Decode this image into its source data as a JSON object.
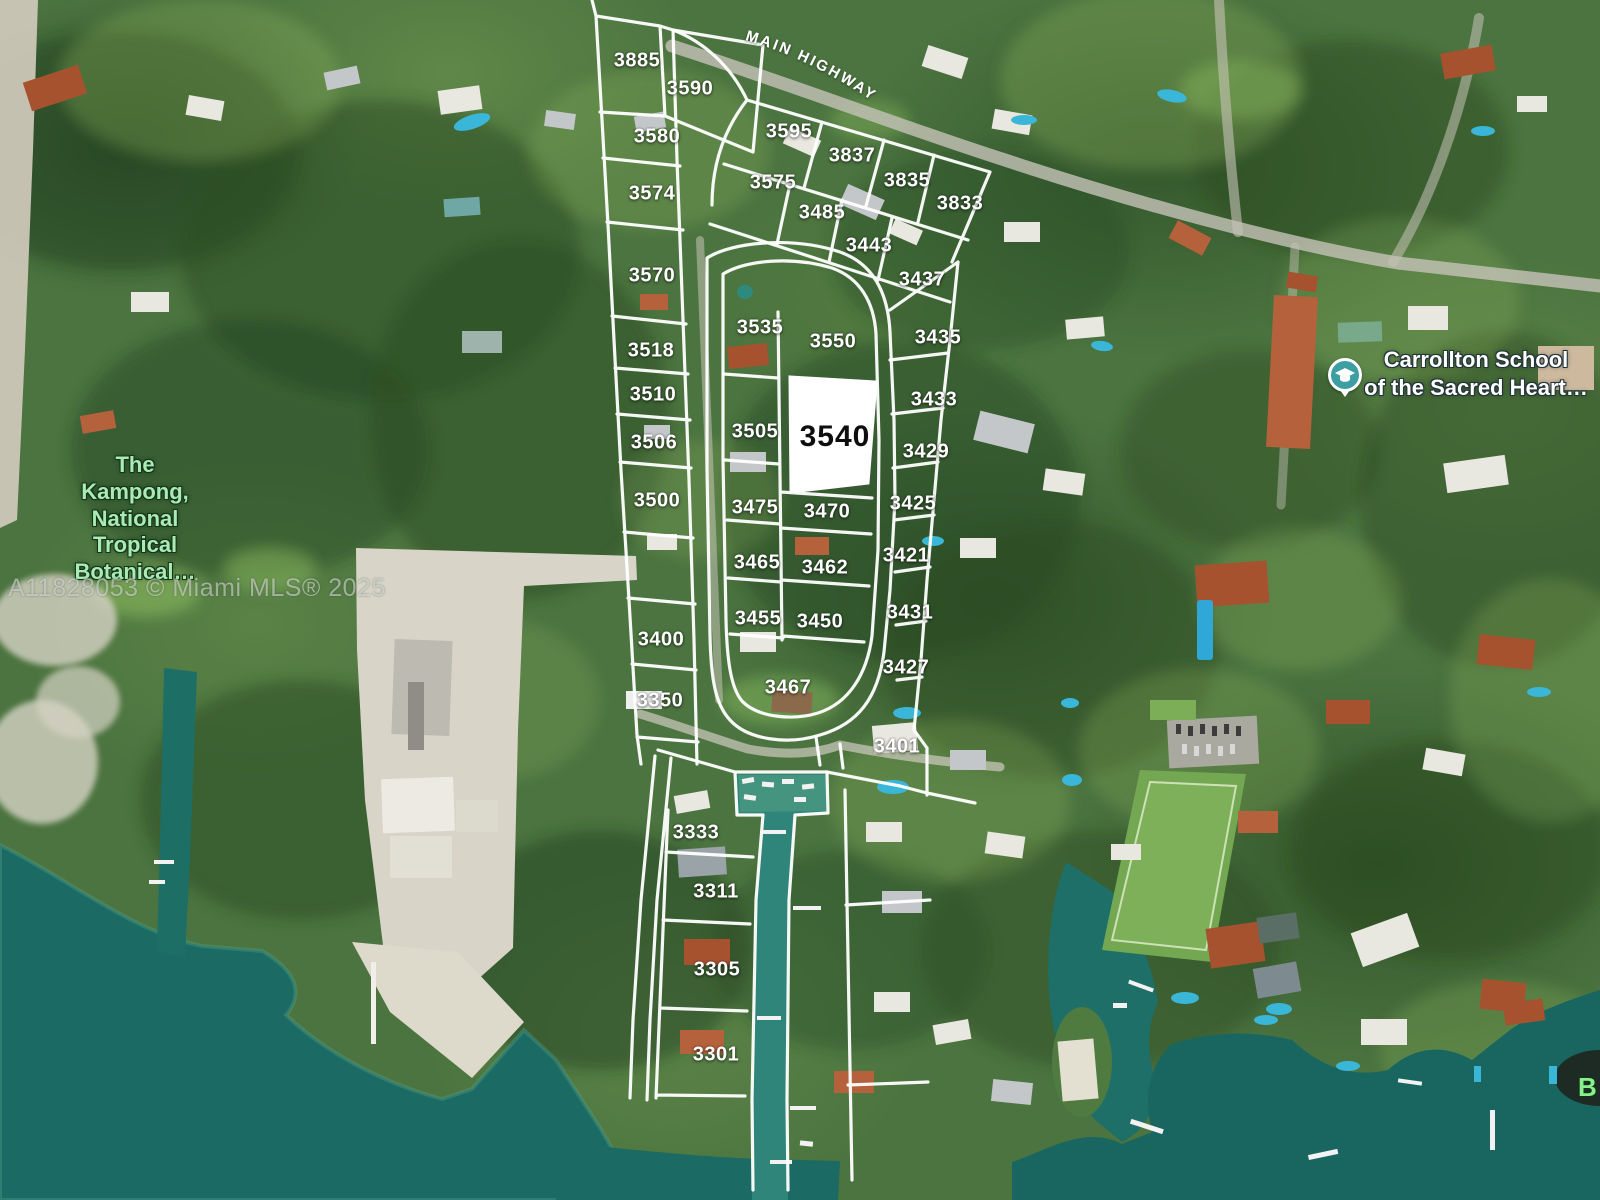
{
  "map": {
    "type": "satellite-parcel-overlay",
    "watermark": "A11828053 © Miami MLS® 2025",
    "road_label": "MAIN HIGHWAY",
    "highlight_lot": "3540",
    "colors": {
      "parcel_line": "#ffffff",
      "highlight_parcel_fill": "#ffffff",
      "highlight_parcel_text": "#0e0e0e",
      "lot_label_text": "#ffffff",
      "bay_water": "#1b6a63",
      "marina_water": "#45947f",
      "vegetation": "#4c7440",
      "sand": "#d8d5c8",
      "poi_green_text": "#a9ebb3",
      "poi_white_text": "#ffffff",
      "school_pin": "#3d9fa2"
    },
    "pois": {
      "kampong": {
        "label": "The Kampong,\nNational\nTropical\nBotanical…"
      },
      "school": {
        "line1": "Carrollton School",
        "line2": "of the Sacred Heart…",
        "icon": "graduation-cap-pin"
      },
      "edge": {
        "label": "B"
      }
    },
    "lots": [
      {
        "number": "3885",
        "x": 637,
        "y": 61
      },
      {
        "number": "3590",
        "x": 690,
        "y": 89
      },
      {
        "number": "3595",
        "x": 789,
        "y": 132
      },
      {
        "number": "3580",
        "x": 657,
        "y": 137
      },
      {
        "number": "3837",
        "x": 852,
        "y": 156
      },
      {
        "number": "3835",
        "x": 907,
        "y": 181
      },
      {
        "number": "3575",
        "x": 773,
        "y": 183
      },
      {
        "number": "3574",
        "x": 652,
        "y": 194
      },
      {
        "number": "3833",
        "x": 960,
        "y": 204
      },
      {
        "number": "3485",
        "x": 822,
        "y": 213
      },
      {
        "number": "3443",
        "x": 869,
        "y": 246
      },
      {
        "number": "3570",
        "x": 652,
        "y": 276
      },
      {
        "number": "3437",
        "x": 922,
        "y": 280
      },
      {
        "number": "3535",
        "x": 760,
        "y": 328
      },
      {
        "number": "3435",
        "x": 938,
        "y": 338
      },
      {
        "number": "3550",
        "x": 833,
        "y": 342
      },
      {
        "number": "3518",
        "x": 651,
        "y": 351
      },
      {
        "number": "3510",
        "x": 653,
        "y": 395
      },
      {
        "number": "3433",
        "x": 934,
        "y": 400
      },
      {
        "number": "3505",
        "x": 755,
        "y": 432
      },
      {
        "number": "3540",
        "x": 835,
        "y": 437,
        "highlight": true
      },
      {
        "number": "3506",
        "x": 654,
        "y": 443
      },
      {
        "number": "3429",
        "x": 926,
        "y": 452
      },
      {
        "number": "3500",
        "x": 657,
        "y": 501
      },
      {
        "number": "3425",
        "x": 913,
        "y": 504
      },
      {
        "number": "3475",
        "x": 755,
        "y": 508
      },
      {
        "number": "3470",
        "x": 827,
        "y": 512
      },
      {
        "number": "3421",
        "x": 906,
        "y": 556
      },
      {
        "number": "3465",
        "x": 757,
        "y": 563
      },
      {
        "number": "3462",
        "x": 825,
        "y": 568
      },
      {
        "number": "3431",
        "x": 910,
        "y": 613
      },
      {
        "number": "3455",
        "x": 758,
        "y": 619
      },
      {
        "number": "3450",
        "x": 820,
        "y": 622
      },
      {
        "number": "3400",
        "x": 661,
        "y": 640
      },
      {
        "number": "3427",
        "x": 906,
        "y": 668
      },
      {
        "number": "3467",
        "x": 788,
        "y": 688
      },
      {
        "number": "3350",
        "x": 660,
        "y": 701
      },
      {
        "number": "3401",
        "x": 897,
        "y": 747
      },
      {
        "number": "3333",
        "x": 696,
        "y": 833
      },
      {
        "number": "3311",
        "x": 716,
        "y": 892
      },
      {
        "number": "3305",
        "x": 717,
        "y": 970
      },
      {
        "number": "3301",
        "x": 716,
        "y": 1055
      }
    ]
  }
}
